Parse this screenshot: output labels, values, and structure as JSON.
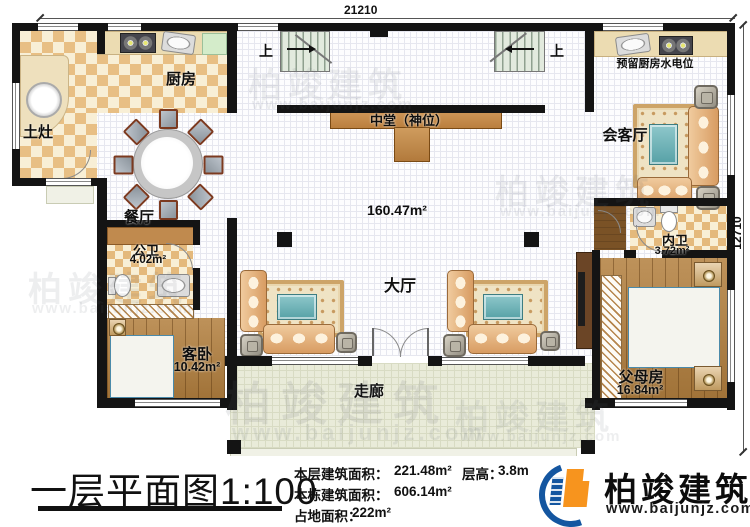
{
  "dimensions": {
    "top": "21210",
    "right": "12710"
  },
  "plan": {
    "stair_up_left": "上",
    "stair_up_right": "上",
    "rooms": {
      "kitchen": {
        "name": "厨房"
      },
      "earth_stove": {
        "name": "土灶"
      },
      "dining": {
        "name": "餐厅"
      },
      "public_bath": {
        "name": "公卫",
        "area": "4.02m²"
      },
      "guest_bedroom": {
        "name": "客卧",
        "area": "10.42m²"
      },
      "central_shrine": {
        "name": "中堂（神位）"
      },
      "main_hall": {
        "name": "大厅",
        "area": "160.47m²"
      },
      "corridor": {
        "name": "走廊"
      },
      "reception": {
        "name": "会客厅"
      },
      "reserved_kitchen": {
        "name": "预留厨房水电位"
      },
      "inner_bath": {
        "name": "内卫",
        "area": "3.72m²"
      },
      "parents_room": {
        "name": "父母房",
        "area": "16.84m²"
      }
    }
  },
  "footer": {
    "title": "一层平面图1:100",
    "line1_label": "本层建筑面积：",
    "line1_value": "221.48m²",
    "height_label": "层高：",
    "height_value": "3.8m",
    "line2_label": "本栋建筑面积：",
    "line2_value": "606.14m²",
    "line3_label": "占地面积：",
    "line3_value": "222m²",
    "brand_name": "柏竣建筑",
    "brand_url": "www.baijunjz.com"
  },
  "watermark": {
    "text": "柏竣建筑",
    "url": "www.baijunjz.com"
  },
  "colors": {
    "brand_blue": "#1456a0",
    "brand_orange": "#f7941e",
    "wall": "#141414"
  }
}
